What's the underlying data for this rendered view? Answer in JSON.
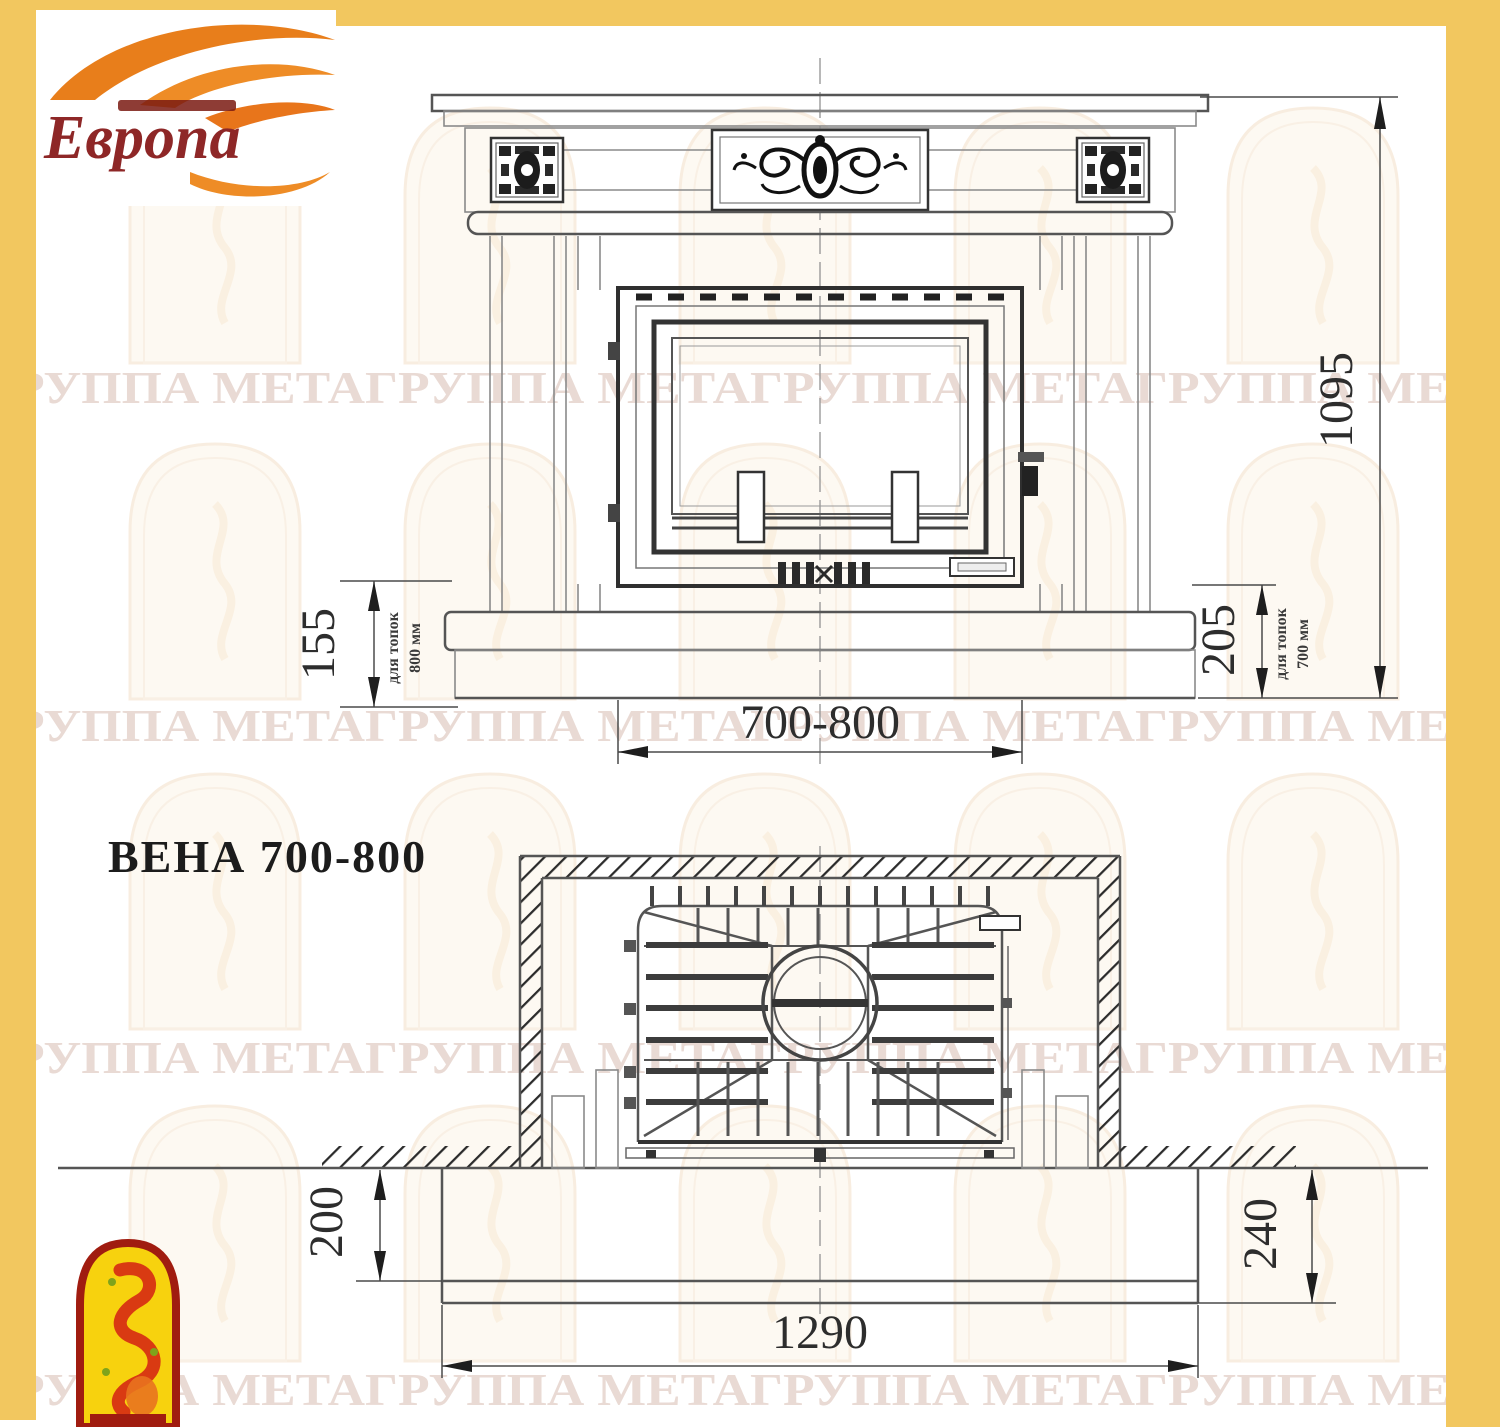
{
  "colors": {
    "frame_yellow": "#F2C75F",
    "logo_red": "#8E2727",
    "flame_orange": "#E87E1B",
    "emblem_yellow": "#F7D20E",
    "emblem_red": "#A01C10",
    "watermark_text": "#D8BDB2",
    "line_gray": "#8A8A8A",
    "line_dark": "#2F2F2F"
  },
  "logo": {
    "brand": "Европа"
  },
  "watermark": {
    "row_text": "ГРУППА МЕТАГРУППА МЕТАГРУППА МЕТАГРУППА МЕТА"
  },
  "drawing": {
    "title": "ВЕНА 700-800",
    "front_view": {
      "dim_total_height": "1095",
      "dim_plinth_left": "155",
      "dim_plinth_left_note_line1": "для топок",
      "dim_plinth_left_note_line2": "800 мм",
      "dim_plinth_right": "205",
      "dim_plinth_right_note_line1": "для топок",
      "dim_plinth_right_note_line2": "700 мм",
      "dim_opening_width": "700-800"
    },
    "plan_view": {
      "dim_hearth_front_left": "200",
      "dim_hearth_front_right": "240",
      "dim_hearth_width": "1290"
    }
  }
}
